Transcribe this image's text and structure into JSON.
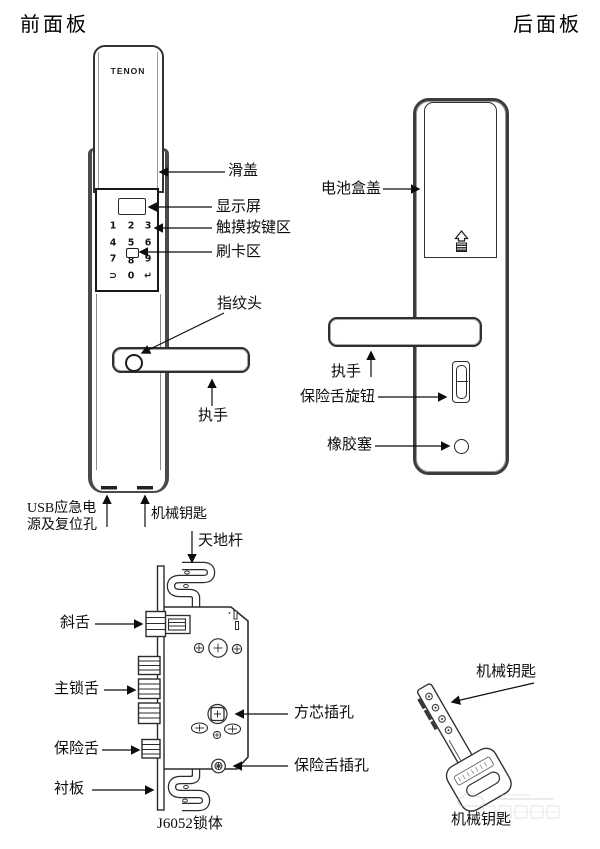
{
  "titles": {
    "front": "前面板",
    "back": "后面板"
  },
  "front_panel": {
    "brand": "TENON",
    "keypad_rows": [
      [
        "1",
        "2",
        "3"
      ],
      [
        "4",
        "5",
        "6"
      ],
      [
        "7",
        "8",
        "9"
      ],
      [
        "⊃",
        "0",
        "↵"
      ]
    ],
    "labels": {
      "slide_cover": "滑盖",
      "display": "显示屏",
      "touch_keys": "触摸按键区",
      "card_area": "刷卡区",
      "fingerprint": "指纹头",
      "handle": "执手",
      "usb_line1": "USB应急电",
      "usb_line2": "源及复位孔",
      "mech_key": "机械钥匙"
    }
  },
  "back_panel": {
    "labels": {
      "battery_cover": "电池盒盖",
      "handle": "执手",
      "safety_knob": "保险舌旋钮",
      "rubber_plug": "橡胶塞"
    }
  },
  "lock_body": {
    "caption": "J6052锁体",
    "labels": {
      "heaven_earth_rod": "天地杆",
      "latch_bolt": "斜舌",
      "main_bolt": "主锁舌",
      "safety_bolt": "保险舌",
      "liner_plate": "衬板",
      "square_core_hole": "方芯插孔",
      "safety_bolt_hole": "保险舌插孔"
    }
  },
  "key": {
    "label": "机械钥匙",
    "caption": "机械钥匙"
  },
  "colors": {
    "line": "#2b2b2b",
    "ink": "#111111",
    "panel_border": "#3d3d3d"
  }
}
